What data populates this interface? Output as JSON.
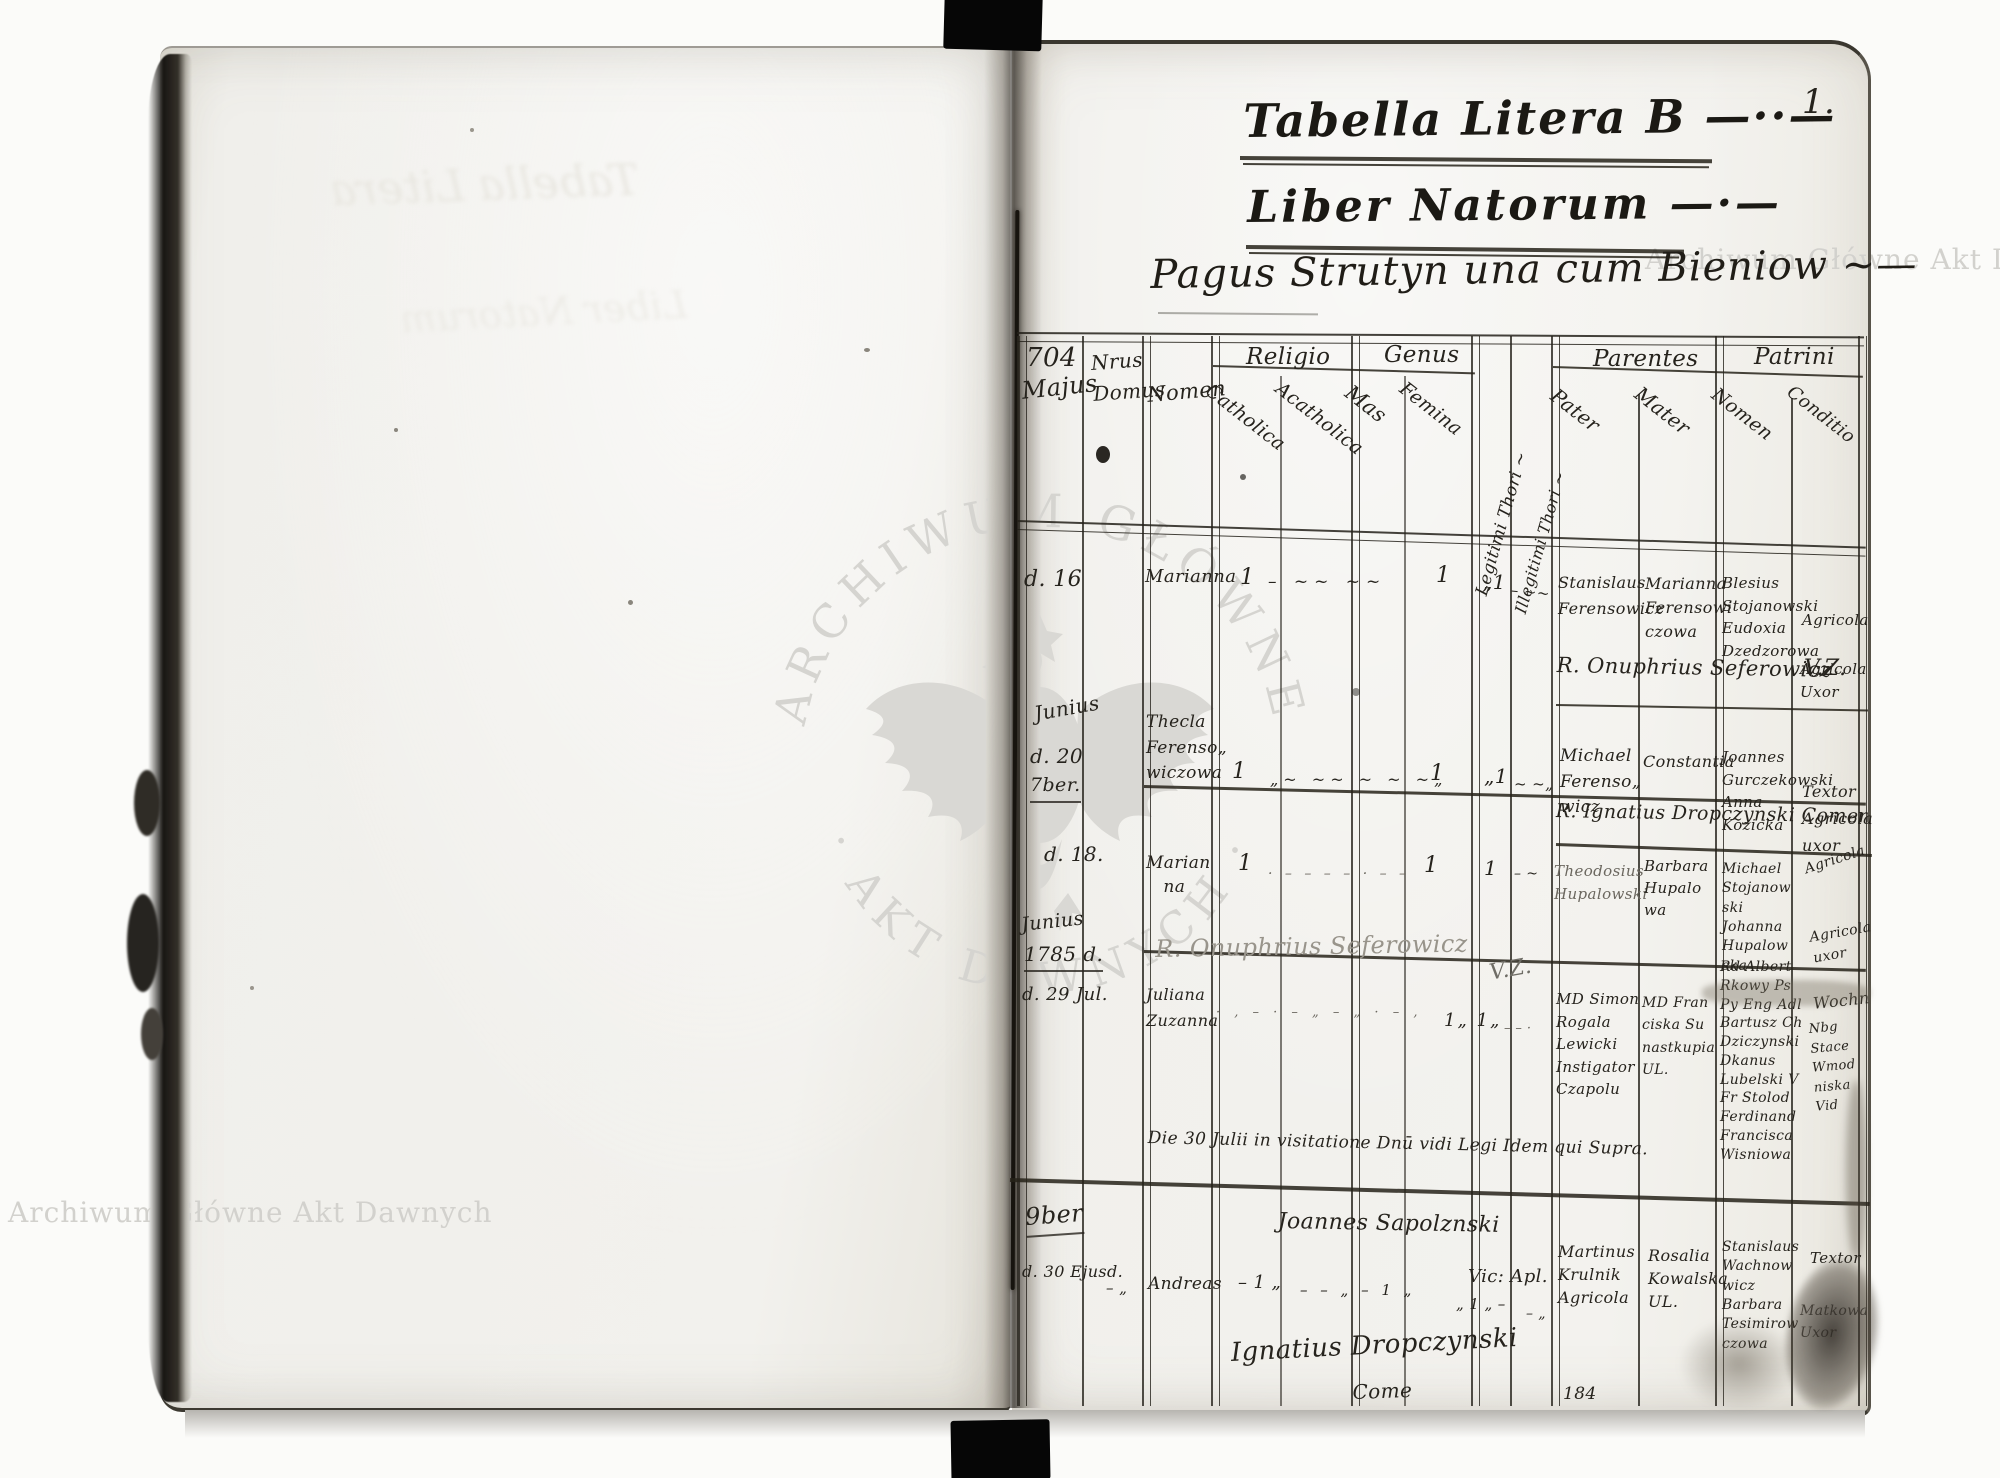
{
  "page": {
    "number": "1."
  },
  "titles": {
    "main": "Tabella Litera B —··—",
    "register": "Liber Natorum —·—",
    "village": "Pagus Strutyn una cum Bieniow ~—"
  },
  "watermark": {
    "top_right": "Archiwum Główne Akt Dawnych",
    "bottom_left": "Archiwum Główne Akt Dawnych",
    "seal_top": "ARCHIWUM GŁÓWNE",
    "seal_bottom": "· AKT DAWNYCH ·"
  },
  "header": {
    "year": "704",
    "month": "Majus",
    "house": "Nrus\nDomus",
    "name": "Nomen",
    "religio": "Religio",
    "catholica": "Catholica",
    "acatholica": "Acatholica",
    "genus": "Genus",
    "mas": "Mas",
    "femina": "Femina",
    "legitimi": "Legitimi Thori ~",
    "illegitimi": "Illegitimi Thori ~",
    "parentes": "Parentes",
    "pater": "Pater",
    "mater": "Mater",
    "patrini": "Patrini",
    "patrini_nomen": "Nomen",
    "conditio": "Conditio"
  },
  "margins": [
    "d. 16",
    "Junius",
    "d. 20",
    "7ber.",
    "d. 18.",
    "Junius",
    "1785 d.",
    "d. 29 Jul.",
    "9ber",
    "d. 30 Ejusd."
  ],
  "records": [
    {
      "nomen": "Marianna",
      "catholica": "1",
      "marks": "–  ~~  ~~",
      "femina": "1",
      "legitimi": "„1",
      "illegitimi": "– ~~",
      "pater": "Stanislaus\nFerensowicz",
      "mater": "Marianna\nFerensowi\nczowa",
      "patrini": "Blesius\nStojanowski\nEudoxia\nDzedzorowa",
      "conditio": "Agricola",
      "conditio2": "Agricola\nUxor"
    },
    {
      "nomen": "Thecla\nFerenso„\nwiczowa",
      "catholica": "1",
      "marks": "„~ ~~ ~ ~ ~„",
      "femina": "1",
      "legitimi": "„1",
      "illegitimi": "~ ~„",
      "pater": "Michael\nFerenso„\nwicz",
      "mater": "Constantia",
      "patrini": "Joannes\nGurczekowski\nAnna\nKozicka",
      "conditio": "Textor\nAgricola\nuxor"
    },
    {
      "nomen": "Marian\n   na",
      "catholica": "1",
      "marks": "· – – – – · – –",
      "femina": "1",
      "legitimi": "1",
      "illegitimi": "– ~",
      "pater": "Theodosius\nHupalowski",
      "mater": "Barbara\nHupalo\nwa",
      "patrini": "Michael\nStojanow\nski\nJohanna\nHupalow\nska",
      "conditio": "Agricola",
      "conditio2": "Agricola\nuxor",
      "conditio3": "Wochn"
    },
    {
      "nomen": "Juliana\nZuzanna",
      "marks": "· , – · – „ – „ · – ,",
      "legitimi": "1„ 1„",
      "illegitimi": "– – ·",
      "pater": "MD Simon\nRogala\nLewicki\nInstigator\nCzapolu",
      "mater": "MD Fran\nciska Su\nnastkupia\nUL.",
      "patrini": "Rd Albert\nRkowy Ps\nPy Eng Adl\nBartusz Ch\nDziczynski\nDkanus\nLubelski V\nFr Stolod\nFerdinand\nFrancisca\nWisniowa",
      "conditio": "Nbg\nStace\nWmod\nniska\nVid"
    },
    {
      "premarks": "– „",
      "nomen": "Andreas",
      "catholica": "– 1 „",
      "marks": "– – „ – 1 „",
      "marks2": "„ 1 „ –",
      "marks3": "– „",
      "pater": "Martinus\nKrulnik\nAgricola",
      "mater": "Rosalia\nKowalska\nUL.",
      "patrini": "Stanislaus\nWachnow\nwicz\nBarbara\nTesimirow\nczowa",
      "conditio": "Textor",
      "conditio2": "Matkowa\nUxor"
    }
  ],
  "notes": {
    "priest1": "R. Onuphrius Seferowicz",
    "vz1": "V.Z.",
    "priest2": "R. Ignatius Dropczynski Coment Ytoczow",
    "priest3": "R. Onuphrius Seferowicz",
    "vz2": "V.Z.",
    "visitation": "Die 30 Julii in visitatione Dnū vidi Legi Idem qui Supra.",
    "vicar": "Joannes Sapolznski",
    "vicar_title": "Vic: Apl.",
    "signature": "Ignatius Dropczynski",
    "signature_suffix": "Come",
    "folio": "184"
  },
  "ghosts": {
    "g1": "Tabella Litera",
    "g2": "Liber Natorum"
  }
}
